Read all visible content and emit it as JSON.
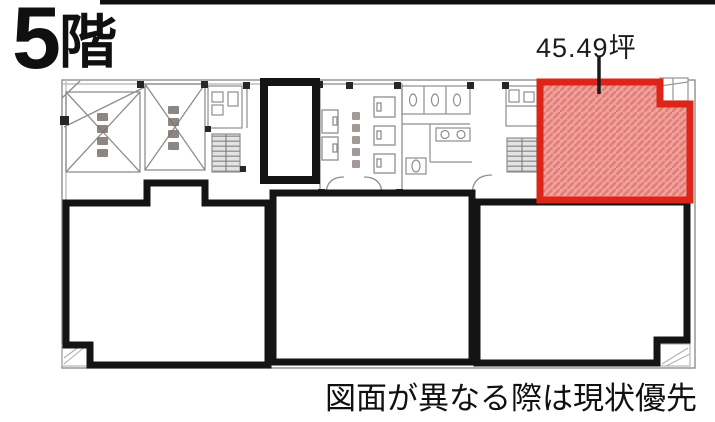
{
  "header": {
    "floor_number": "5",
    "floor_suffix": "階"
  },
  "highlight": {
    "area_label": "45.49坪",
    "border_color": "#dc2418",
    "fill_color": "#f0a19c",
    "hatch_color": "#e27d76"
  },
  "footer": {
    "disclaimer": "図面が異なる際は現状優先"
  },
  "plan": {
    "wall_color": "#8e8e8e",
    "boundary_color": "#141414",
    "highlighted_unit_location": "top-right"
  }
}
